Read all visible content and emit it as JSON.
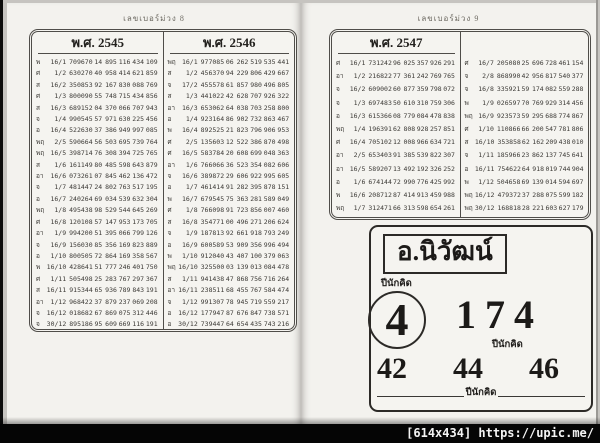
{
  "pages": [
    {
      "header": "เลขเบอร์ม่วง 8",
      "columns": [
        {
          "title": "พ.ศ. 2545",
          "rows": [
            [
              "พ",
              "16/1",
              "709670",
              "14",
              "895",
              "116",
              "434",
              "109"
            ],
            [
              "ศ",
              "1/2",
              "630270",
              "40",
              "958",
              "414",
              "621",
              "859"
            ],
            [
              "ส",
              "16/2",
              "350853",
              "92",
              "167",
              "830",
              "088",
              "769"
            ],
            [
              "ศ",
              "1/3",
              "800090",
              "55",
              "748",
              "715",
              "434",
              "856"
            ],
            [
              "ส",
              "16/3",
              "689152",
              "04",
              "370",
              "066",
              "707",
              "943"
            ],
            [
              "จ",
              "1/4",
              "990545",
              "57",
              "971",
              "630",
              "225",
              "456"
            ],
            [
              "อ",
              "16/4",
              "522630",
              "37",
              "386",
              "949",
              "997",
              "085"
            ],
            [
              "พฤ",
              "2/5",
              "590664",
              "56",
              "503",
              "695",
              "739",
              "764"
            ],
            [
              "พฤ",
              "16/5",
              "398714",
              "76",
              "308",
              "394",
              "725",
              "765"
            ],
            [
              "ส",
              "1/6",
              "161149",
              "80",
              "485",
              "598",
              "643",
              "879"
            ],
            [
              "อา",
              "16/6",
              "073261",
              "07",
              "845",
              "462",
              "136",
              "472"
            ],
            [
              "จ",
              "1/7",
              "481447",
              "24",
              "802",
              "763",
              "517",
              "195"
            ],
            [
              "อ",
              "16/7",
              "240264",
              "69",
              "034",
              "539",
              "632",
              "304"
            ],
            [
              "พฤ",
              "1/8",
              "495438",
              "98",
              "529",
              "544",
              "645",
              "269"
            ],
            [
              "ศ",
              "16/8",
              "120108",
              "57",
              "147",
              "953",
              "173",
              "705"
            ],
            [
              "อา",
              "1/9",
              "994200",
              "51",
              "395",
              "066",
              "799",
              "126"
            ],
            [
              "จ",
              "16/9",
              "156030",
              "85",
              "356",
              "169",
              "823",
              "889"
            ],
            [
              "อ",
              "1/10",
              "800505",
              "72",
              "864",
              "169",
              "358",
              "567"
            ],
            [
              "พ",
              "16/10",
              "428641",
              "51",
              "777",
              "246",
              "401",
              "750"
            ],
            [
              "ศ",
              "1/11",
              "505498",
              "25",
              "283",
              "767",
              "297",
              "367"
            ],
            [
              "ส",
              "16/11",
              "915344",
              "65",
              "936",
              "789",
              "843",
              "191"
            ],
            [
              "อา",
              "1/12",
              "968422",
              "37",
              "879",
              "237",
              "069",
              "208"
            ],
            [
              "จ",
              "16/12",
              "018682",
              "67",
              "869",
              "075",
              "312",
              "446"
            ],
            [
              "จ",
              "30/12",
              "895186",
              "95",
              "609",
              "669",
              "116",
              "191"
            ]
          ]
        },
        {
          "title": "พ.ศ. 2546",
          "rows": [
            [
              "พฤ",
              "16/1",
              "977085",
              "06",
              "262",
              "519",
              "535",
              "441"
            ],
            [
              "ส",
              "1/2",
              "456370",
              "94",
              "229",
              "806",
              "429",
              "667"
            ],
            [
              "จ",
              "17/2",
              "455578",
              "61",
              "857",
              "980",
              "496",
              "805"
            ],
            [
              "ส",
              "1/3",
              "441022",
              "42",
              "628",
              "707",
              "926",
              "322"
            ],
            [
              "อา",
              "16/3",
              "653062",
              "64",
              "038",
              "703",
              "258",
              "800"
            ],
            [
              "อ",
              "1/4",
              "923164",
              "86",
              "902",
              "732",
              "863",
              "467"
            ],
            [
              "พ",
              "16/4",
              "892525",
              "21",
              "823",
              "796",
              "906",
              "953"
            ],
            [
              "ศ",
              "2/5",
              "135603",
              "12",
              "522",
              "386",
              "870",
              "498"
            ],
            [
              "ศ",
              "16/5",
              "583784",
              "20",
              "608",
              "699",
              "048",
              "363"
            ],
            [
              "อา",
              "1/6",
              "766066",
              "36",
              "523",
              "354",
              "082",
              "606"
            ],
            [
              "จ",
              "16/6",
              "389872",
              "29",
              "606",
              "922",
              "995",
              "605"
            ],
            [
              "อ",
              "1/7",
              "461414",
              "91",
              "282",
              "395",
              "878",
              "151"
            ],
            [
              "พ",
              "16/7",
              "679545",
              "75",
              "363",
              "281",
              "589",
              "049"
            ],
            [
              "ศ",
              "1/8",
              "766098",
              "91",
              "723",
              "856",
              "007",
              "460"
            ],
            [
              "ส",
              "16/8",
              "354771",
              "00",
              "496",
              "271",
              "206",
              "624"
            ],
            [
              "จ",
              "1/9",
              "187813",
              "92",
              "661",
              "918",
              "793",
              "249"
            ],
            [
              "อ",
              "16/9",
              "600589",
              "53",
              "909",
              "356",
              "996",
              "494"
            ],
            [
              "พ",
              "1/10",
              "912040",
              "43",
              "407",
              "100",
              "379",
              "063"
            ],
            [
              "พฤ",
              "16/10",
              "325500",
              "03",
              "139",
              "013",
              "084",
              "478"
            ],
            [
              "ส",
              "1/11",
              "941438",
              "47",
              "868",
              "756",
              "716",
              "264"
            ],
            [
              "อา",
              "16/11",
              "238511",
              "68",
              "455",
              "767",
              "584",
              "474"
            ],
            [
              "จ",
              "1/12",
              "991307",
              "78",
              "945",
              "719",
              "559",
              "217"
            ],
            [
              "อ",
              "16/12",
              "177947",
              "87",
              "676",
              "847",
              "738",
              "571"
            ],
            [
              "อ",
              "30/12",
              "739447",
              "64",
              "654",
              "435",
              "743",
              "216"
            ]
          ]
        }
      ]
    },
    {
      "header": "เลขเบอร์ม่วง 9",
      "columns": [
        {
          "title": "พ.ศ. 2547",
          "rows": [
            [
              "ศ",
              "16/1",
              "731242",
              "96",
              "025",
              "357",
              "926",
              "291"
            ],
            [
              "อา",
              "1/2",
              "216822",
              "77",
              "361",
              "242",
              "769",
              "765"
            ],
            [
              "จ",
              "16/2",
              "609002",
              "60",
              "877",
              "359",
              "798",
              "072"
            ],
            [
              "จ",
              "1/3",
              "697483",
              "50",
              "610",
              "310",
              "759",
              "306"
            ],
            [
              "อ",
              "16/3",
              "615366",
              "08",
              "779",
              "084",
              "478",
              "838"
            ],
            [
              "พฤ",
              "1/4",
              "196391",
              "62",
              "808",
              "928",
              "257",
              "851"
            ],
            [
              "ศ",
              "16/4",
              "705102",
              "12",
              "008",
              "966",
              "634",
              "721"
            ],
            [
              "อา",
              "2/5",
              "653403",
              "91",
              "385",
              "539",
              "822",
              "307"
            ],
            [
              "อา",
              "16/5",
              "589207",
              "13",
              "492",
              "192",
              "326",
              "252"
            ],
            [
              "อ",
              "1/6",
              "674144",
              "72",
              "990",
              "776",
              "425",
              "992"
            ],
            [
              "พ",
              "16/6",
              "208712",
              "87",
              "414",
              "913",
              "459",
              "988"
            ],
            [
              "พฤ",
              "1/7",
              "312471",
              "66",
              "313",
              "598",
              "654",
              "261"
            ]
          ]
        },
        {
          "title": "",
          "rows": [
            [
              "ศ",
              "16/7",
              "205080",
              "25",
              "696",
              "728",
              "461",
              "154"
            ],
            [
              "จ",
              "2/8",
              "868990",
              "42",
              "956",
              "817",
              "540",
              "377"
            ],
            [
              "จ",
              "16/8",
              "335921",
              "59",
              "174",
              "082",
              "559",
              "288"
            ],
            [
              "พ",
              "1/9",
              "026597",
              "70",
              "769",
              "929",
              "314",
              "456"
            ],
            [
              "พฤ",
              "16/9",
              "923573",
              "59",
              "295",
              "688",
              "774",
              "867"
            ],
            [
              "ศ",
              "1/10",
              "110866",
              "66",
              "200",
              "547",
              "781",
              "806"
            ],
            [
              "ส",
              "16/10",
              "353858",
              "62",
              "162",
              "209",
              "438",
              "010"
            ],
            [
              "จ",
              "1/11",
              "185966",
              "23",
              "862",
              "137",
              "745",
              "641"
            ],
            [
              "อ",
              "16/11",
              "754622",
              "64",
              "918",
              "019",
              "744",
              "904"
            ],
            [
              "พ",
              "1/12",
              "504658",
              "69",
              "139",
              "014",
              "594",
              "697"
            ],
            [
              "พฤ",
              "16/12",
              "479372",
              "37",
              "288",
              "075",
              "599",
              "182"
            ],
            [
              "พฤ",
              "30/12",
              "168818",
              "28",
              "221",
              "603",
              "627",
              "179"
            ]
          ]
        }
      ],
      "prediction": {
        "name": "อ.นิวัฒน์",
        "label_top": "ปีนักคิด",
        "circled_number": "4",
        "big_number": "174",
        "label_mid": "ปีนักคิด",
        "bottom_numbers": [
          "42",
          "44",
          "46"
        ],
        "label_bottom": "ปีนักคิด"
      }
    }
  ],
  "watermark": "[614x434] https://upic.me/"
}
